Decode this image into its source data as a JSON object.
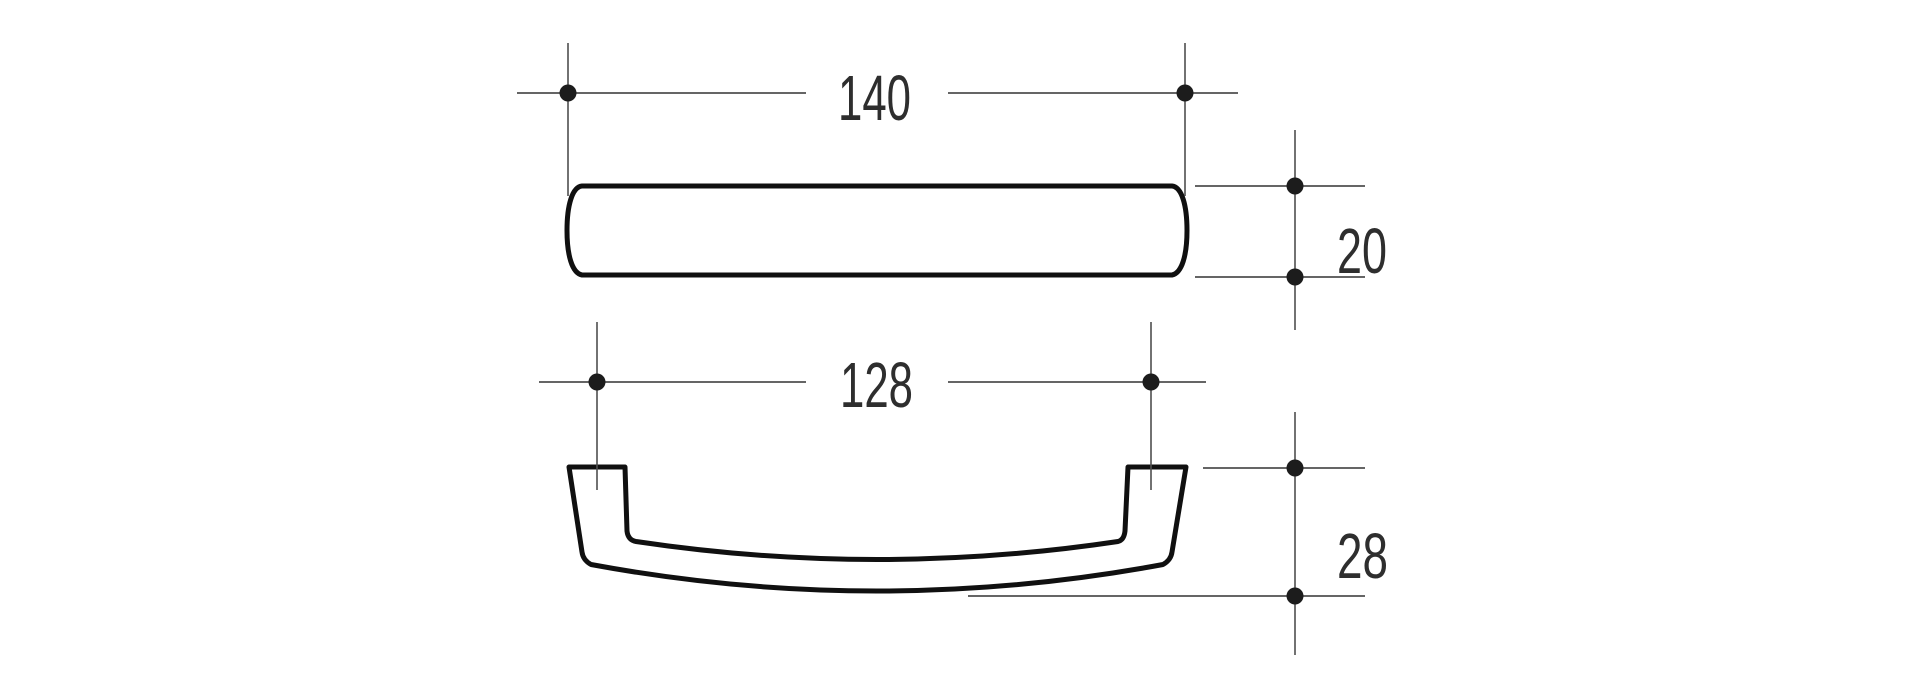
{
  "drawing": {
    "type": "technical-drawing",
    "subject": "cabinet-pull-handle",
    "views": {
      "top_view": {
        "name": "handle top view (profile bar)"
      },
      "front_view": {
        "name": "handle front view (bow with two feet)"
      }
    }
  },
  "dimensions": {
    "overall_length": {
      "label": "140"
    },
    "profile_height": {
      "label": "20"
    },
    "hole_spacing": {
      "label": "128"
    },
    "front_height": {
      "label": "28"
    }
  },
  "colors": {
    "background": "#ffffff",
    "outline": "#101010",
    "dimension_line": "#4f4f4f",
    "dimension_dot": "#1c1c1c",
    "dimension_text": "#2e2e2e"
  }
}
